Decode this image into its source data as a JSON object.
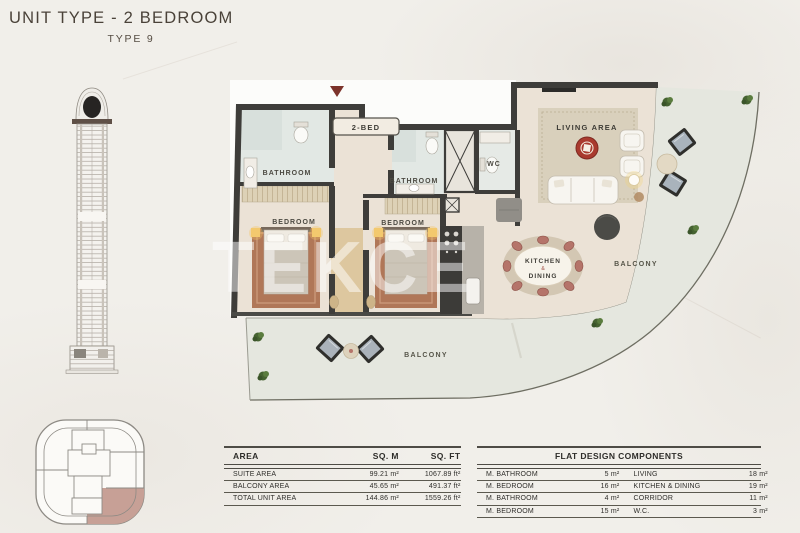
{
  "header": {
    "title": "UNIT TYPE - 2 BEDROOM",
    "subtitle": "TYPE 9"
  },
  "plan": {
    "badge": "2-BED",
    "watermark": "TEKCE",
    "labels": {
      "bathroom_1": "BATHROOM",
      "bedroom_1": "BEDROOM",
      "bathroom_2": "BATHROOM",
      "bedroom_2": "BEDROOM",
      "wc": "WC",
      "living_area": "LIVING AREA",
      "kitchen_line1": "KITCHEN",
      "kitchen_line2": "&",
      "kitchen_line3": "DINING",
      "balcony_right": "BALCONY",
      "balcony_bottom": "BALCONY"
    }
  },
  "area_table": {
    "headers": {
      "area": "AREA",
      "sqm": "SQ. M",
      "sqft": "SQ. FT"
    },
    "rows": [
      {
        "label": "SUITE AREA",
        "sqm": "99.21 m²",
        "sqft": "1067.89 ft²"
      },
      {
        "label": "BALCONY AREA",
        "sqm": "45.65 m²",
        "sqft": "491.37 ft²"
      },
      {
        "label": "TOTAL UNIT AREA",
        "sqm": "144.86 m²",
        "sqft": "1559.26 ft²"
      }
    ]
  },
  "components_table": {
    "title": "FLAT DESIGN COMPONENTS",
    "rows": [
      {
        "l_label": "M. BATHROOM",
        "l_value": "5 m²",
        "r_label": "LIVING",
        "r_value": "18 m²"
      },
      {
        "l_label": "M. BEDROOM",
        "l_value": "16 m²",
        "r_label": "KITCHEN & DINING",
        "r_value": "19 m²"
      },
      {
        "l_label": "M. BATHROOM",
        "l_value": "4 m²",
        "r_label": "CORRIDOR",
        "r_value": "11 m²"
      },
      {
        "l_label": "M. BEDROOM",
        "l_value": "15 m²",
        "r_label": "W.C.",
        "r_value": "3 m²"
      }
    ]
  },
  "colors": {
    "accent_red": "#a93a2e",
    "wall": "#3e3d3a",
    "balcony_floor": "#e5e7df",
    "keyplan_highlight": "#c7a096",
    "title_text": "#4a4239"
  }
}
